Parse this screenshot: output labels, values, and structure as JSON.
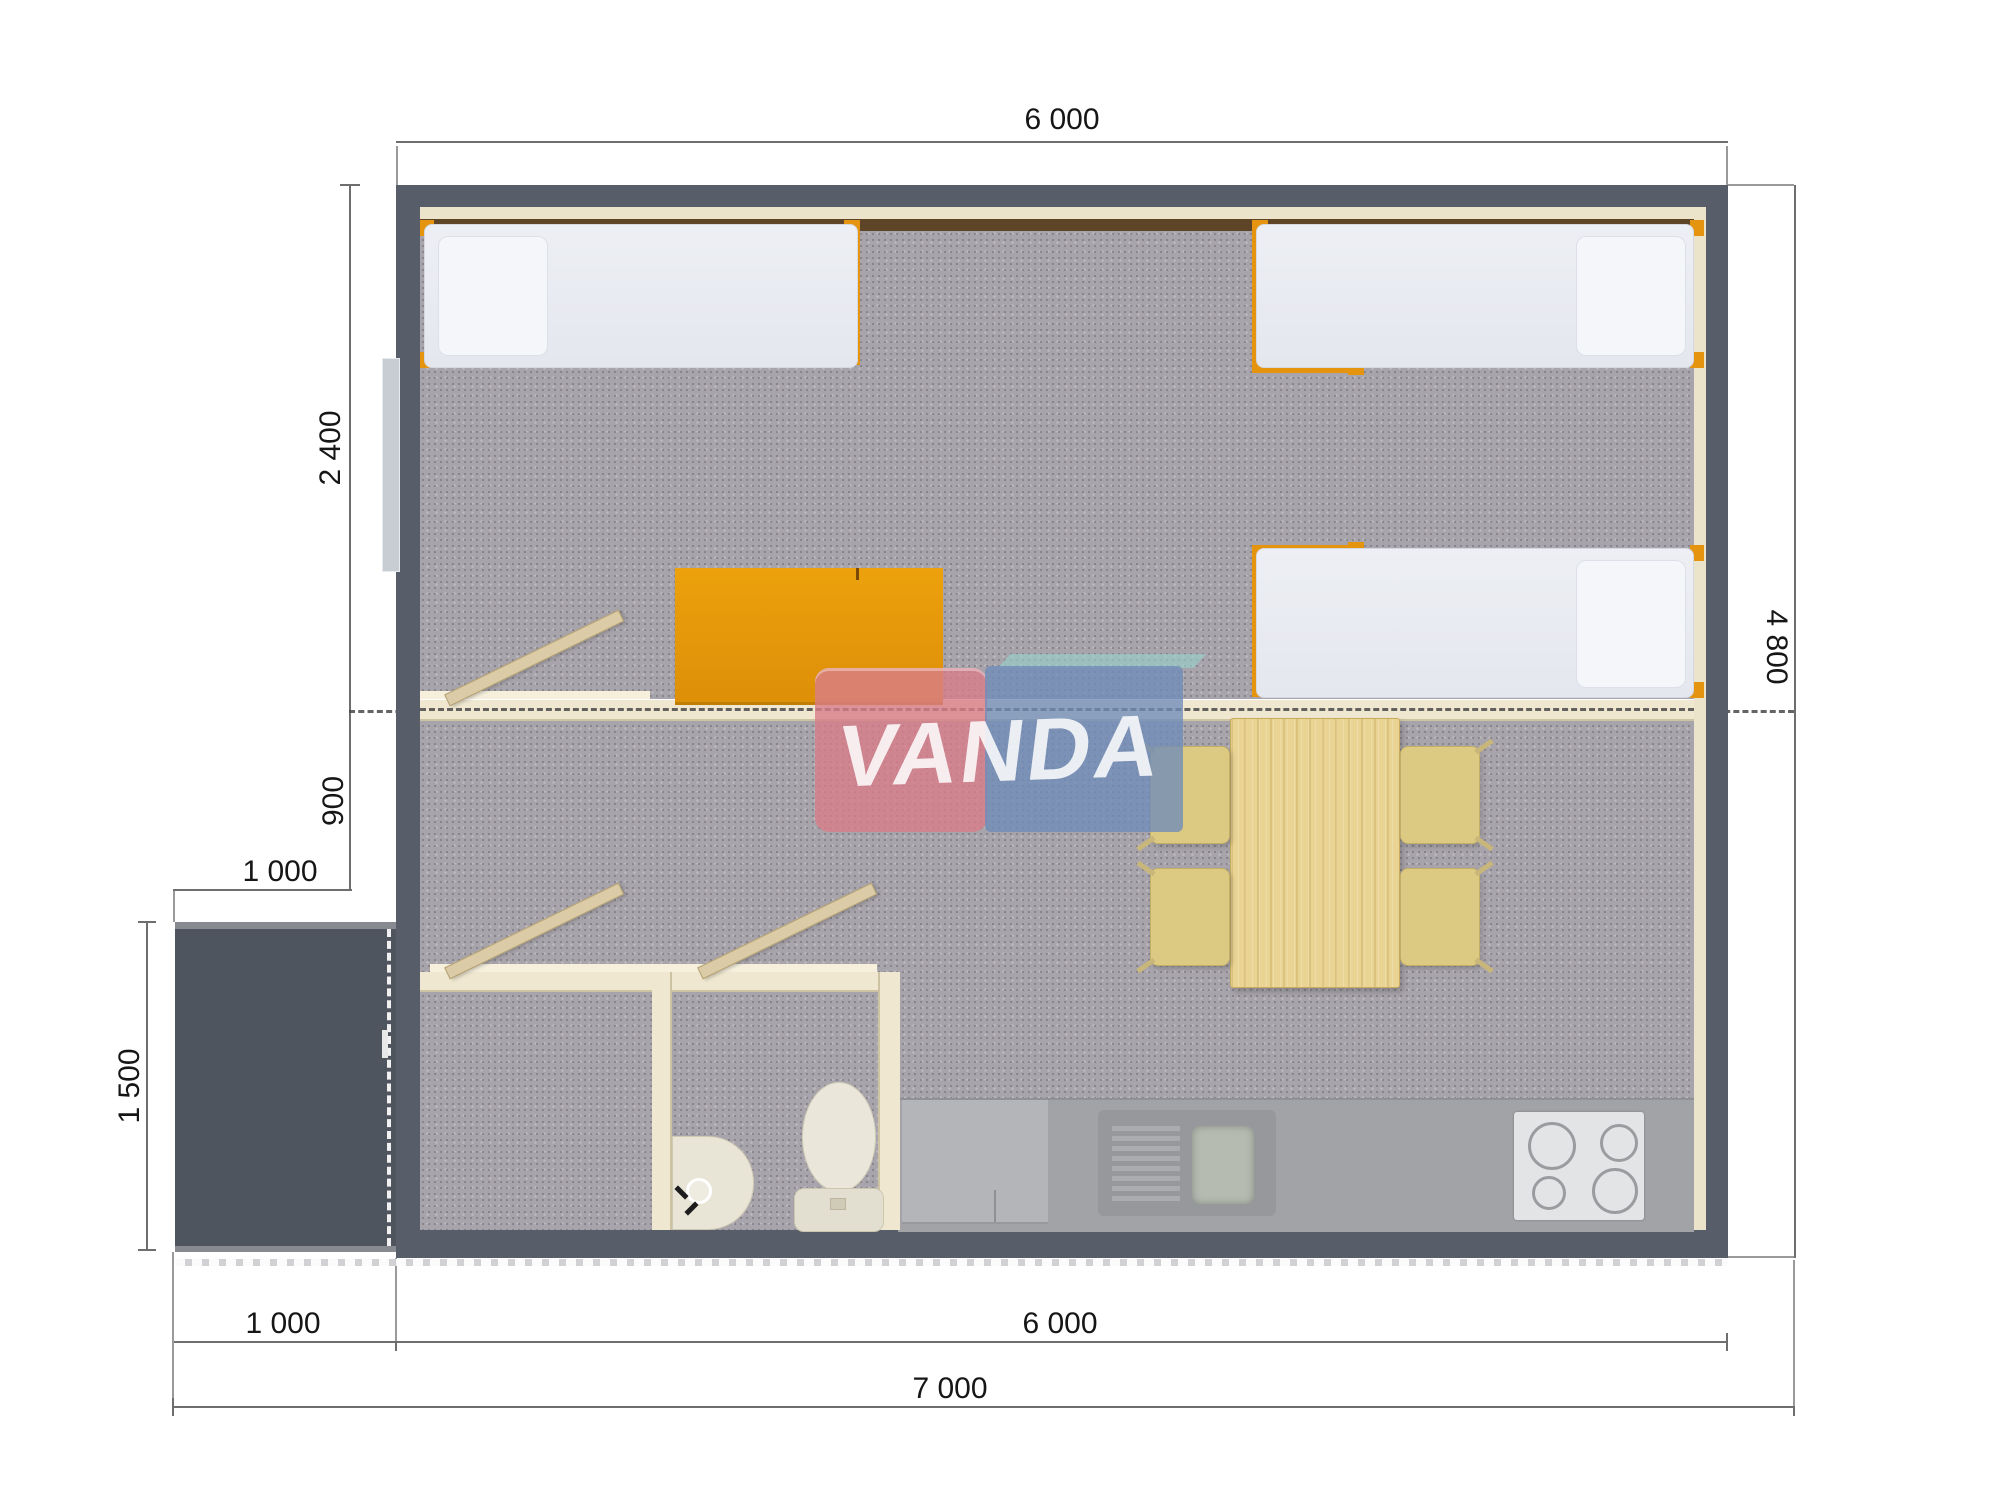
{
  "title": "prefab-cabin-floor-plan",
  "watermark": {
    "text": "VANDA"
  },
  "dimensions": {
    "top_width": "6 000",
    "left_bedroom_depth": "2 400",
    "left_hall_depth": "900",
    "porch_width": "1 000",
    "porch_depth": "1 500",
    "right_height": "4 800",
    "bottom_porch_width": "1 000",
    "bottom_house_width": "6 000",
    "bottom_total_width": "7 000"
  },
  "colors": {
    "wall": "#585e69",
    "porch": "#4f555f",
    "carpet": "#a8a4ab",
    "vinyl": "#a1a3a7",
    "partition": "#efe7cf",
    "accent_orange": "#e59410",
    "wood": "#e9d494",
    "watermark_pink": "#d87d89",
    "watermark_blue": "#6e8cb9",
    "watermark_teal": "#96d0c8"
  },
  "plan": {
    "objects": [
      "single-bed x3",
      "wardrobe",
      "dining-table",
      "chair x4",
      "kitchen-counter",
      "kitchen-sink",
      "stove",
      "fridge",
      "wash-basin",
      "toilet",
      "interior-door x3",
      "window",
      "entrance-porch"
    ]
  }
}
